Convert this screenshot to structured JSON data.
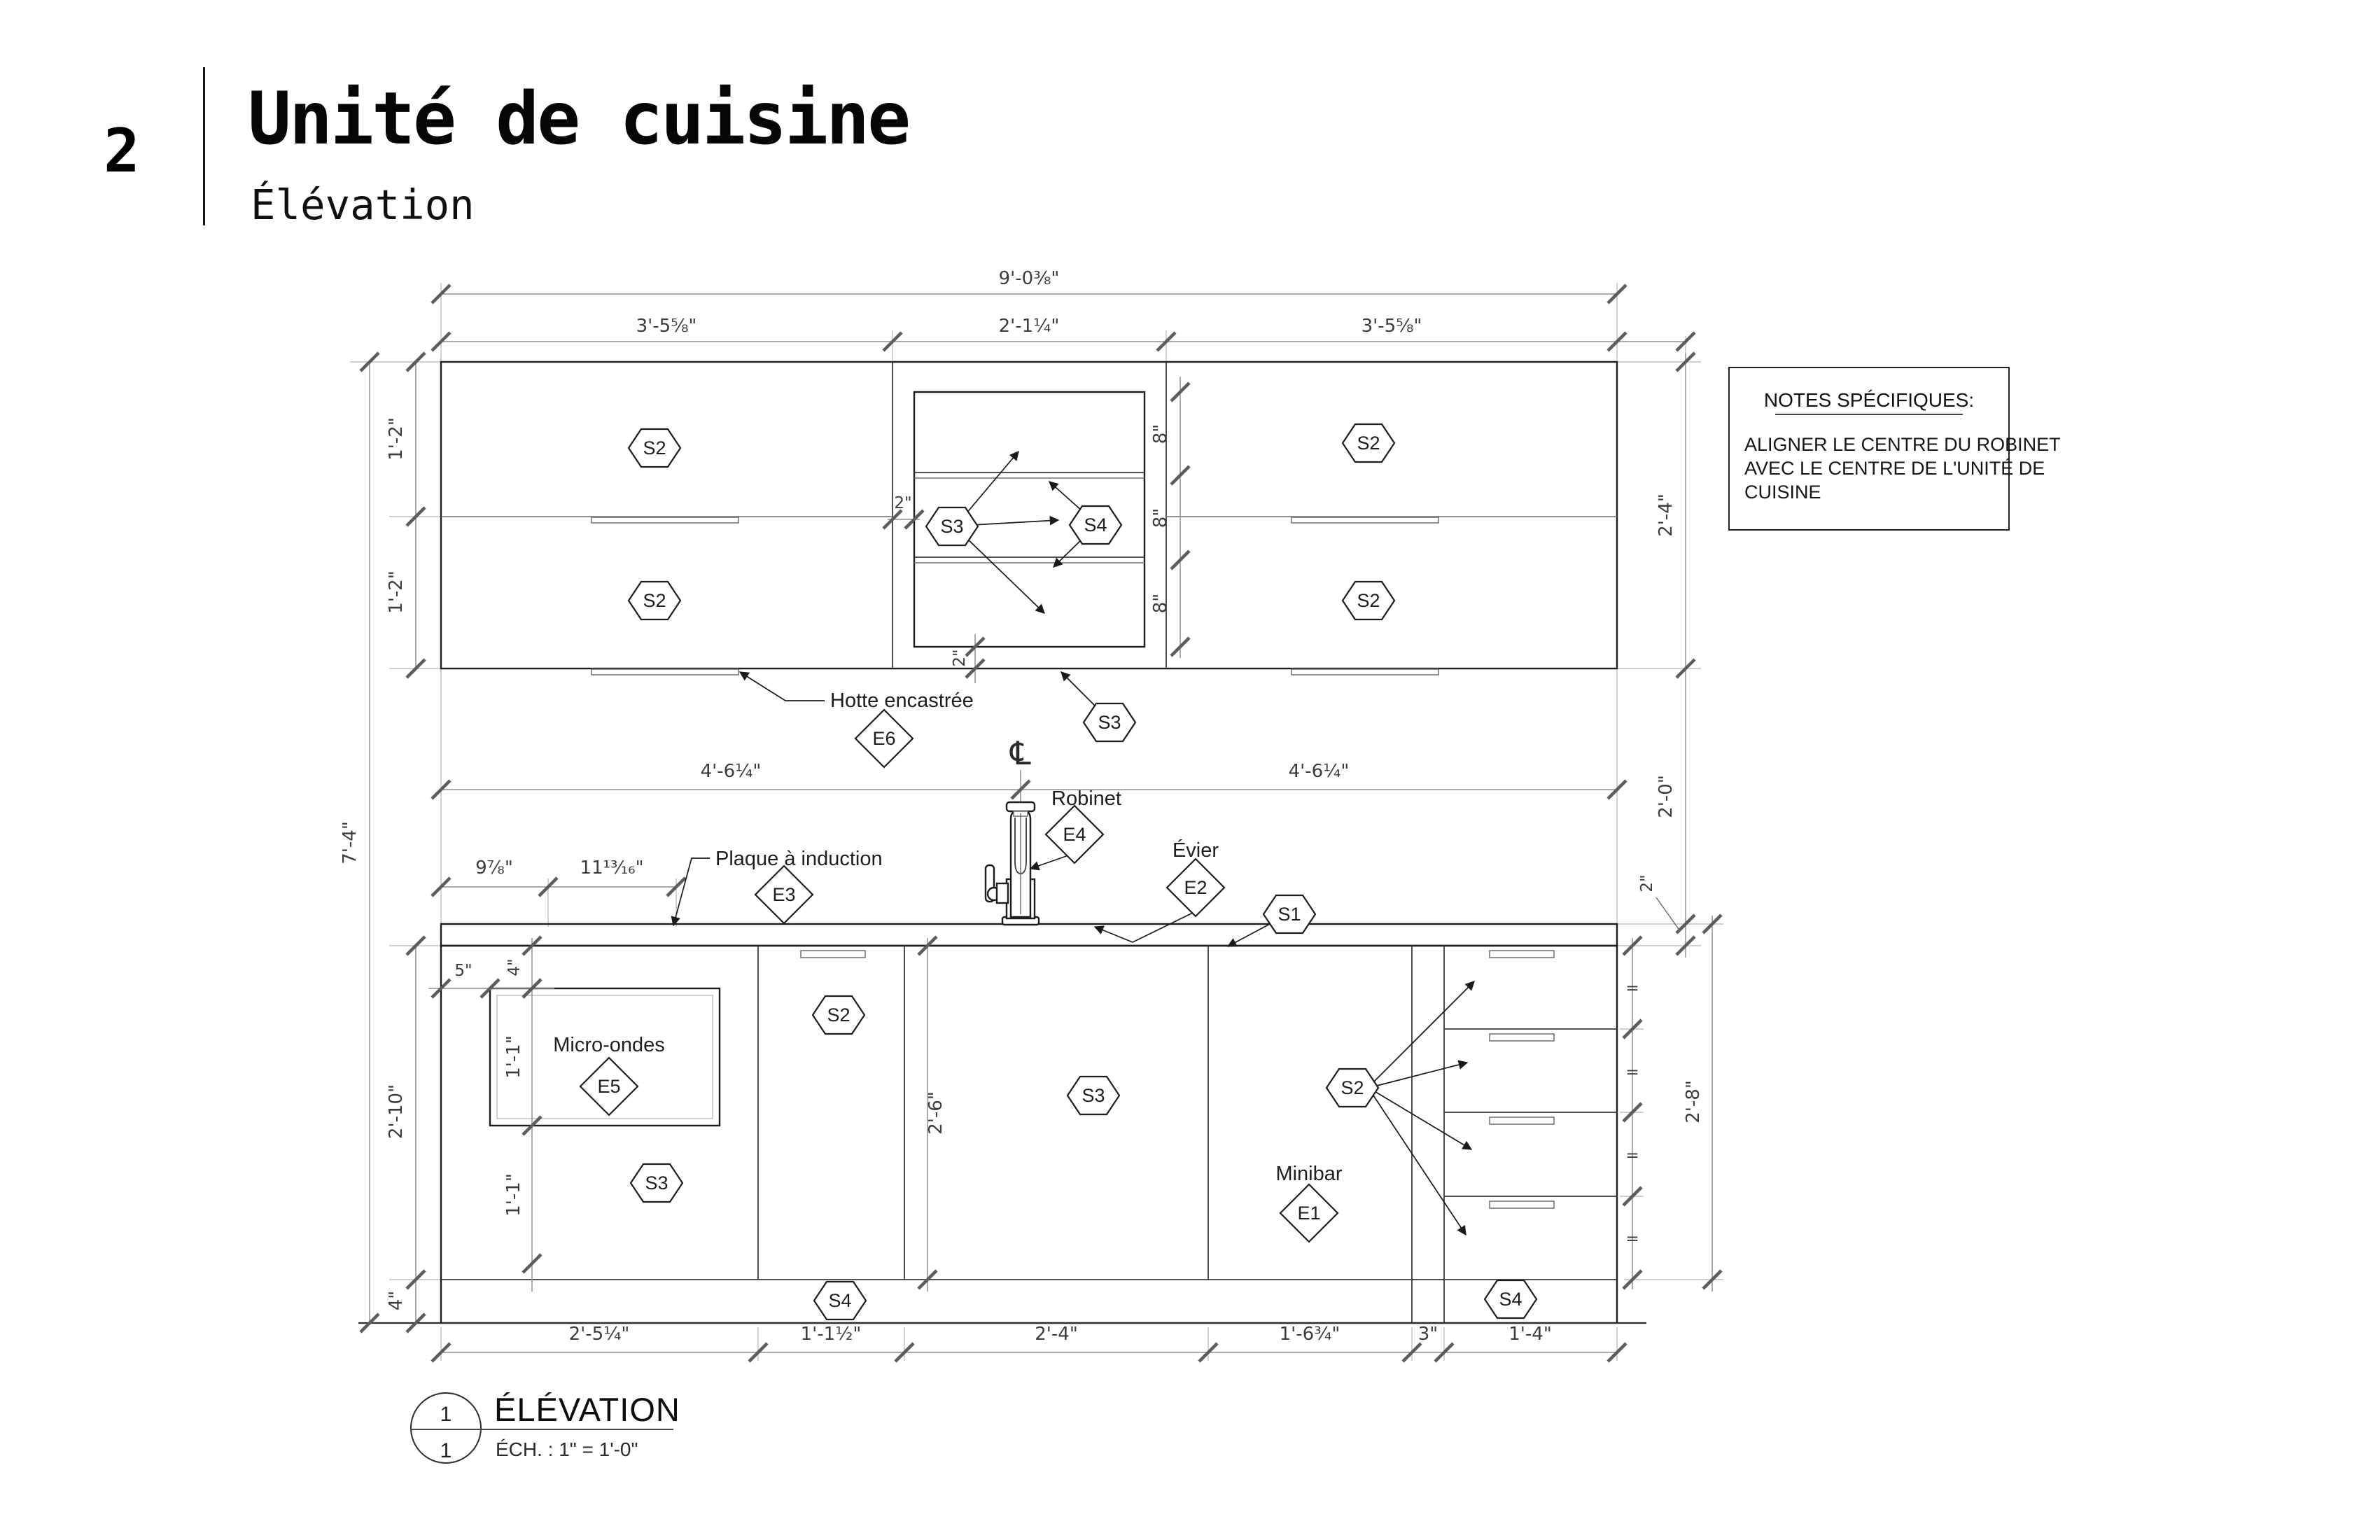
{
  "header": {
    "sheet_number": "2",
    "title": "Unité de cuisine",
    "subtitle": "Élévation"
  },
  "notes": {
    "title": "NOTES SPÉCIFIQUES:",
    "line1": "ALIGNER LE CENTRE DU ROBINET",
    "line2": "AVEC LE CENTRE DE L'UNITÉ DE",
    "line3": "CUISINE"
  },
  "view_title": {
    "detail_number": "1",
    "sheet_ref": "1",
    "name": "ÉLÉVATION",
    "scale": "ÉCH. : 1\" = 1'-0\""
  },
  "labels": {
    "hood": "Hotte encastrée",
    "faucet": "Robinet",
    "sink": "Évier",
    "cooktop": "Plaque à induction",
    "microwave": "Micro-ondes",
    "minibar": "Minibar",
    "centerline": "℄"
  },
  "tags": {
    "s1": "S1",
    "s2": "S2",
    "s3": "S3",
    "s4": "S4",
    "e1": "E1",
    "e2": "E2",
    "e3": "E3",
    "e4": "E4",
    "e5": "E5",
    "e6": "E6"
  },
  "dims": {
    "overall_width": "9'-0⅜\"",
    "upper_left": "3'-5⅝\"",
    "upper_mid": "2'-1¼\"",
    "upper_right": "3'-5⅝\"",
    "upper_door": "1'-2\"",
    "upper_height": "2'-4\"",
    "shelf_gap": "8\"",
    "two_in": "2\"",
    "splash_height": "2'-0\"",
    "half_width": "4'-6¼\"",
    "cooktop_offset": "9⅞\"",
    "cooktop_width": "11¹³⁄₁₆\"",
    "total_height": "7'-4\"",
    "base_height": "2'-10\"",
    "toe_kick": "4\"",
    "niche_offset": "5\"",
    "niche_top": "4\"",
    "niche_height": "1'-1\"",
    "below_niche": "1'-1\"",
    "sink_door_height": "2'-6\"",
    "drawer_stack_height": "2'-8\"",
    "equal": "=",
    "b1": "2'-5¼\"",
    "b2": "1'-1½\"",
    "b3": "2'-4\"",
    "b4": "1'-6¾\"",
    "b5": "3\"",
    "b6": "1'-4\""
  }
}
